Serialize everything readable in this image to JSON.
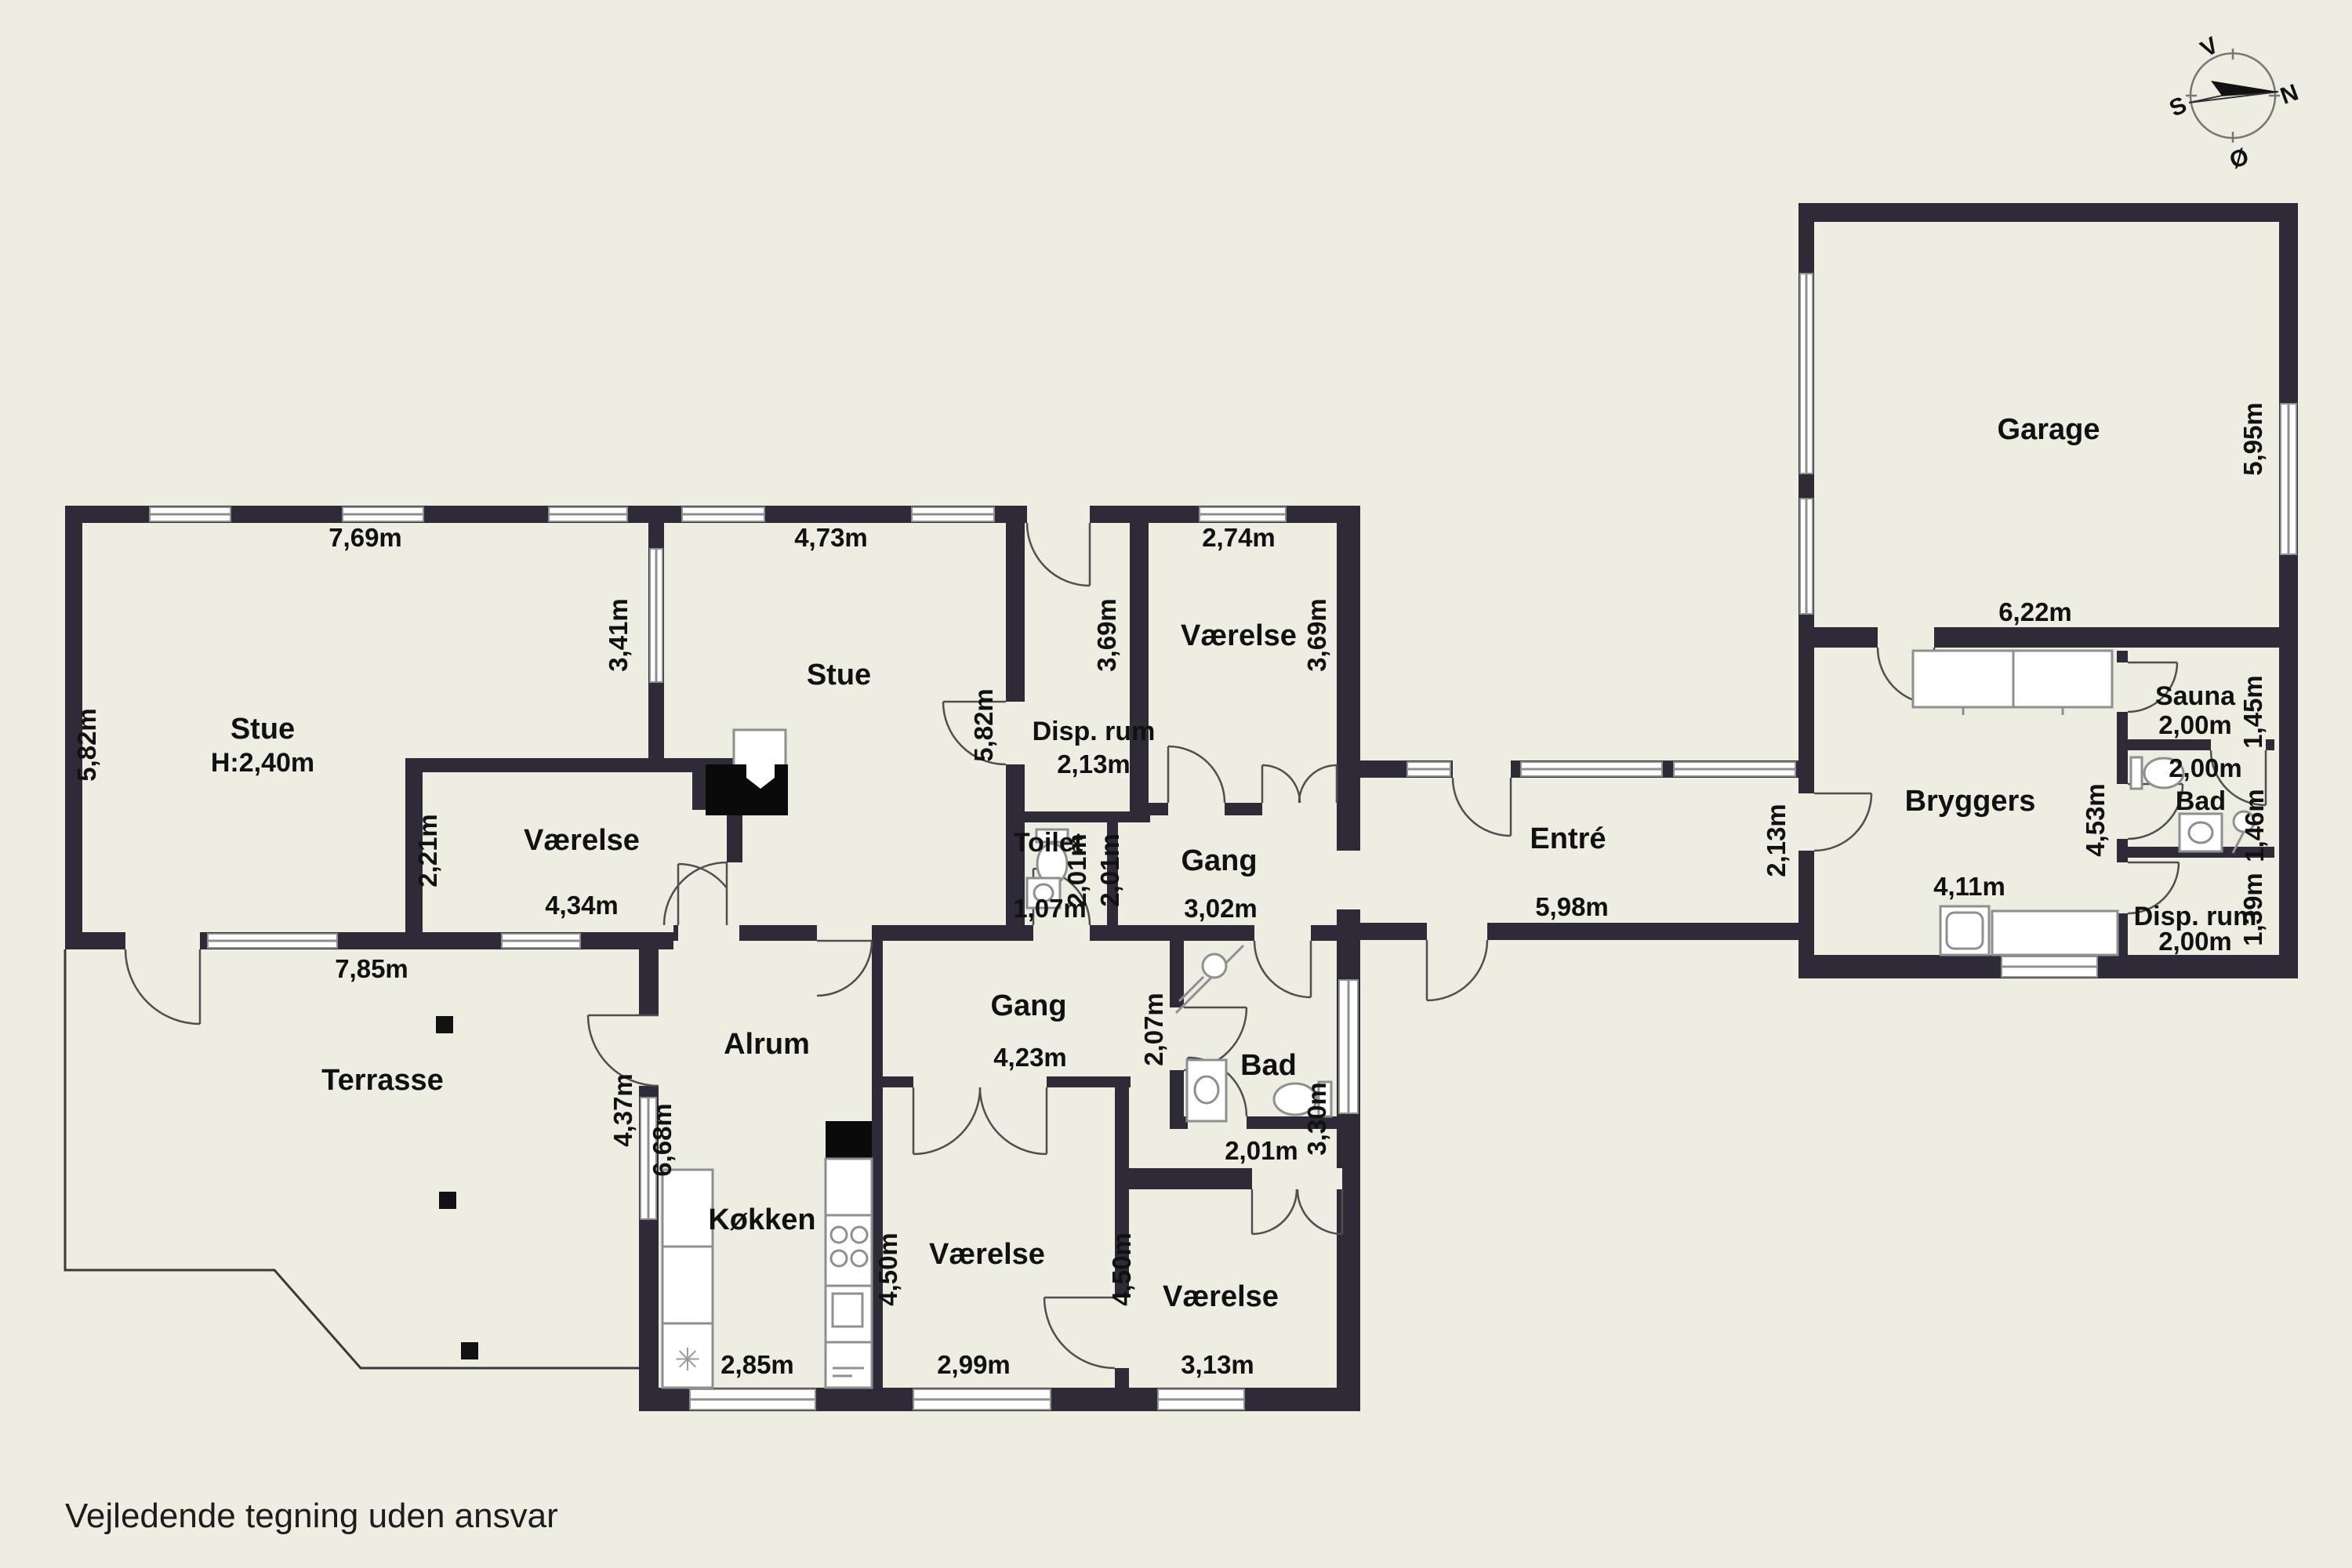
{
  "page": {
    "footer": "Vejledende tegning uden ansvar",
    "background_color": "#eeede2",
    "wall_color": "#2e2a38"
  },
  "compass": {
    "north": "N",
    "south": "S",
    "east": "Ø",
    "west": "V"
  },
  "rooms": {
    "stue_left": {
      "name": "Stue",
      "ceiling_height": "H:2,40m"
    },
    "stue_mid": {
      "name": "Stue"
    },
    "disp_mid": {
      "name": "Disp. rum"
    },
    "vaerelse_top_right": {
      "name": "Værelse"
    },
    "toilet": {
      "name": "Toilet"
    },
    "gang_upper": {
      "name": "Gang"
    },
    "entre": {
      "name": "Entré"
    },
    "garage": {
      "name": "Garage"
    },
    "bryggers": {
      "name": "Bryggers"
    },
    "sauna": {
      "name": "Sauna"
    },
    "bad_right": {
      "name": "Bad"
    },
    "disp_right": {
      "name": "Disp. rum"
    },
    "vaerelse_left": {
      "name": "Værelse"
    },
    "terrasse": {
      "name": "Terrasse"
    },
    "alrum": {
      "name": "Alrum"
    },
    "gang_lower": {
      "name": "Gang"
    },
    "bad_lower": {
      "name": "Bad"
    },
    "kokken": {
      "name": "Køkken"
    },
    "vaerelse_bottom_mid": {
      "name": "Værelse"
    },
    "vaerelse_bottom_right": {
      "name": "Værelse"
    }
  },
  "dimensions": {
    "stue_left_width": "7,69m",
    "stue_left_height": "5,82m",
    "stue_left_south": "7,85m",
    "stue_partition": "3,41m",
    "stue_mid_width": "4,73m",
    "stue_mid_height": "5,82m",
    "vaerelse_tr_width": "2,74m",
    "vaerelse_tr_left": "3,69m",
    "vaerelse_tr_right": "3,69m",
    "disp_mid_width": "2,13m",
    "toilet_width": "1,07m",
    "toilet_depth": "2,01m",
    "gang_upper_depth": "2,01m",
    "gang_upper_width": "3,02m",
    "entre_width": "5,98m",
    "entre_height": "2,13m",
    "garage_width": "6,22m",
    "garage_height": "5,95m",
    "sauna_width": "2,00m",
    "sauna_height": "1,45m",
    "bad_right_width": "2,00m",
    "bad_right_height": "1,46m",
    "bryggers_width": "4,11m",
    "bryggers_height": "4,53m",
    "disp_right_width": "2,00m",
    "disp_right_height": "1,39m",
    "vaerelse_left_width": "4,34m",
    "vaerelse_left_height": "2,21m",
    "terrasse_wall": "4,37m",
    "alrum_height": "6,68m",
    "gang_lower_width": "4,23m",
    "gang_lower_height": "2,07m",
    "bad_lower_height": "3,30m",
    "bad_lower_width": "2,01m",
    "kokken_width": "2,85m",
    "vaerelse_bm_width": "2,99m",
    "vaerelse_bm_height": "4,50m",
    "vaerelse_br_width": "3,13m",
    "vaerelse_br_height": "4,50m"
  }
}
